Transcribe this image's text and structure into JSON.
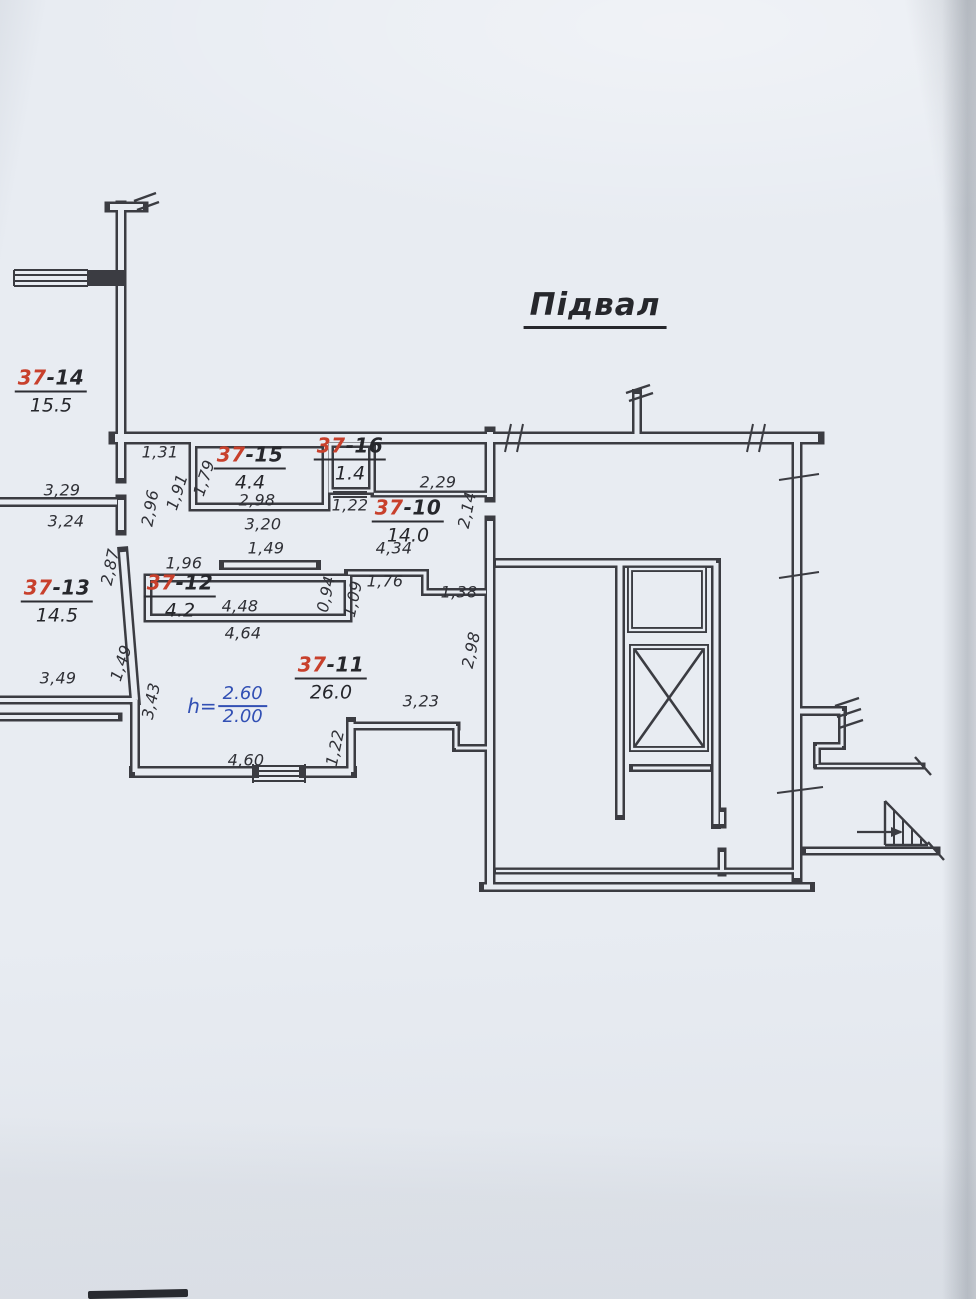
{
  "title": "Підвал",
  "rooms": [
    {
      "number_red": "37",
      "number_rest": "-14",
      "area": "15.5"
    },
    {
      "number_red": "37",
      "number_rest": "-15",
      "area": "4.4"
    },
    {
      "number_red": "37",
      "number_rest": "-16",
      "area": "1.4"
    },
    {
      "number_red": "37",
      "number_rest": "-10",
      "area": "14.0"
    },
    {
      "number_red": "37",
      "number_rest": "-13",
      "area": "14.5"
    },
    {
      "number_red": "37",
      "number_rest": "-12",
      "area": "4.2"
    },
    {
      "number_red": "37",
      "number_rest": "-11",
      "area": "26.0"
    }
  ],
  "height_note": {
    "prefix": "h=",
    "upper": "2.60",
    "lower": "2.00"
  },
  "dimensions": [
    {
      "text": "1,31"
    },
    {
      "text": "3,29"
    },
    {
      "text": "3,24"
    },
    {
      "text": "2,96"
    },
    {
      "text": "1,91"
    },
    {
      "text": "1,79"
    },
    {
      "text": "2,98"
    },
    {
      "text": "3,20"
    },
    {
      "text": "1,49"
    },
    {
      "text": "1,96"
    },
    {
      "text": "1,22"
    },
    {
      "text": "2,29"
    },
    {
      "text": "2,14"
    },
    {
      "text": "4,34"
    },
    {
      "text": "2,87"
    },
    {
      "text": "4,48"
    },
    {
      "text": "4,64"
    },
    {
      "text": "0,94"
    },
    {
      "text": "1,09"
    },
    {
      "text": "1,76"
    },
    {
      "text": "1,38"
    },
    {
      "text": "2,98"
    },
    {
      "text": "3,49"
    },
    {
      "text": "1,49"
    },
    {
      "text": "3,43"
    },
    {
      "text": "3,23"
    },
    {
      "text": "1,22"
    },
    {
      "text": "4,60"
    }
  ],
  "colors": {
    "paper": "#e8ecf2",
    "ink": "#3b3c42",
    "room_number_accent": "#c8402c",
    "height_note_blue": "#3250b4"
  }
}
